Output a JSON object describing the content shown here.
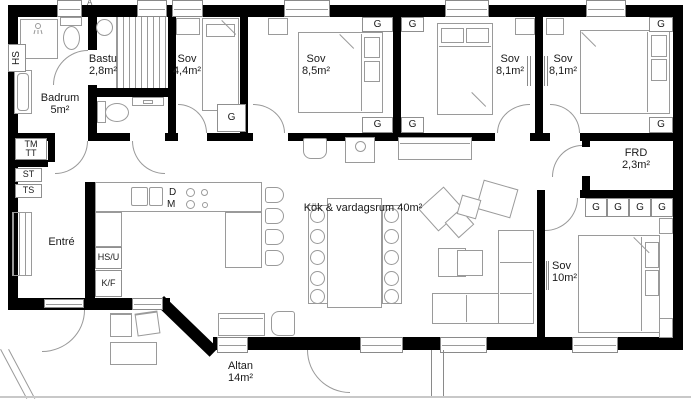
{
  "marker": "A",
  "rooms": {
    "badrum": {
      "name": "Badrum",
      "area": "5m²"
    },
    "bastu": {
      "name": "Bastu",
      "area": "2,8m²"
    },
    "sov44": {
      "name": "Sov",
      "area": "4,4m²"
    },
    "sov85": {
      "name": "Sov",
      "area": "8,5m²"
    },
    "sov81a": {
      "name": "Sov",
      "area": "8,1m²"
    },
    "sov81b": {
      "name": "Sov",
      "area": "8,1m²"
    },
    "kok": {
      "name": "Kök & vardagsrum 40m²"
    },
    "frd": {
      "name": "FRD",
      "area": "2,3m²"
    },
    "sov10": {
      "name": "Sov",
      "area": "10m²"
    },
    "entre": {
      "name": "Entré"
    },
    "altan": {
      "name": "Altan",
      "area": "14m²"
    }
  },
  "labels": {
    "hs": "HS",
    "tm": "TM",
    "tt": "TT",
    "st": "ST",
    "ts": "TS",
    "hsu": "HS/U",
    "kf": "K/F",
    "d": "D",
    "m": "M",
    "g": "G"
  }
}
